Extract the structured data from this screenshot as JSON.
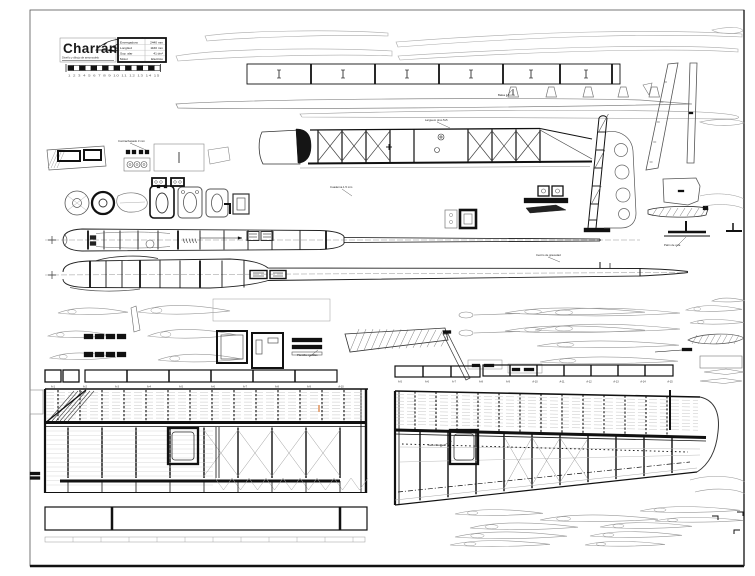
{
  "title_block": {
    "title": "Charrán",
    "subtitle": "Diseño y dibujo de aeromodelo",
    "specs": [
      {
        "label": "Envergadura",
        "value": "2440 mm"
      },
      {
        "label": "Longitud",
        "value": "1160 mm"
      },
      {
        "label": "Sup. alar",
        "value": "41 dm²"
      },
      {
        "label": "Motor",
        "value": "Eléctrico"
      }
    ],
    "scale_numbers": "1 2 3 4 5 6 7 8 9 10 11 12 13 14 15"
  },
  "wing": {
    "rib_labels_left": [
      "A-1",
      "A-2",
      "A-3",
      "A-4",
      "A-5",
      "A-6",
      "A-7",
      "A-8",
      "A-9",
      "A-10"
    ],
    "rib_labels_right": [
      "A-5",
      "A-6",
      "A-7",
      "A-8",
      "A-9",
      "A-10",
      "A-11",
      "A-12",
      "A-13",
      "A-14",
      "A-15"
    ]
  },
  "annotations": [
    {
      "text": "Contrachapado 3 mm"
    },
    {
      "text": "Balsa 1.5 mm"
    },
    {
      "text": "Larguero pino 5x5"
    },
    {
      "text": "Cuaderna 1.5 mm"
    },
    {
      "text": "Centro de gravedad"
    },
    {
      "text": "Plantilla costillas"
    },
    {
      "text": "Servo alerón"
    },
    {
      "text": "Patín de cola"
    }
  ],
  "colors": {
    "paper": "#ffffff",
    "ink": "#1a1a1a",
    "mid_line": "#666666",
    "light_line": "#aaaaaa",
    "accent_mark": "#d2691e"
  }
}
